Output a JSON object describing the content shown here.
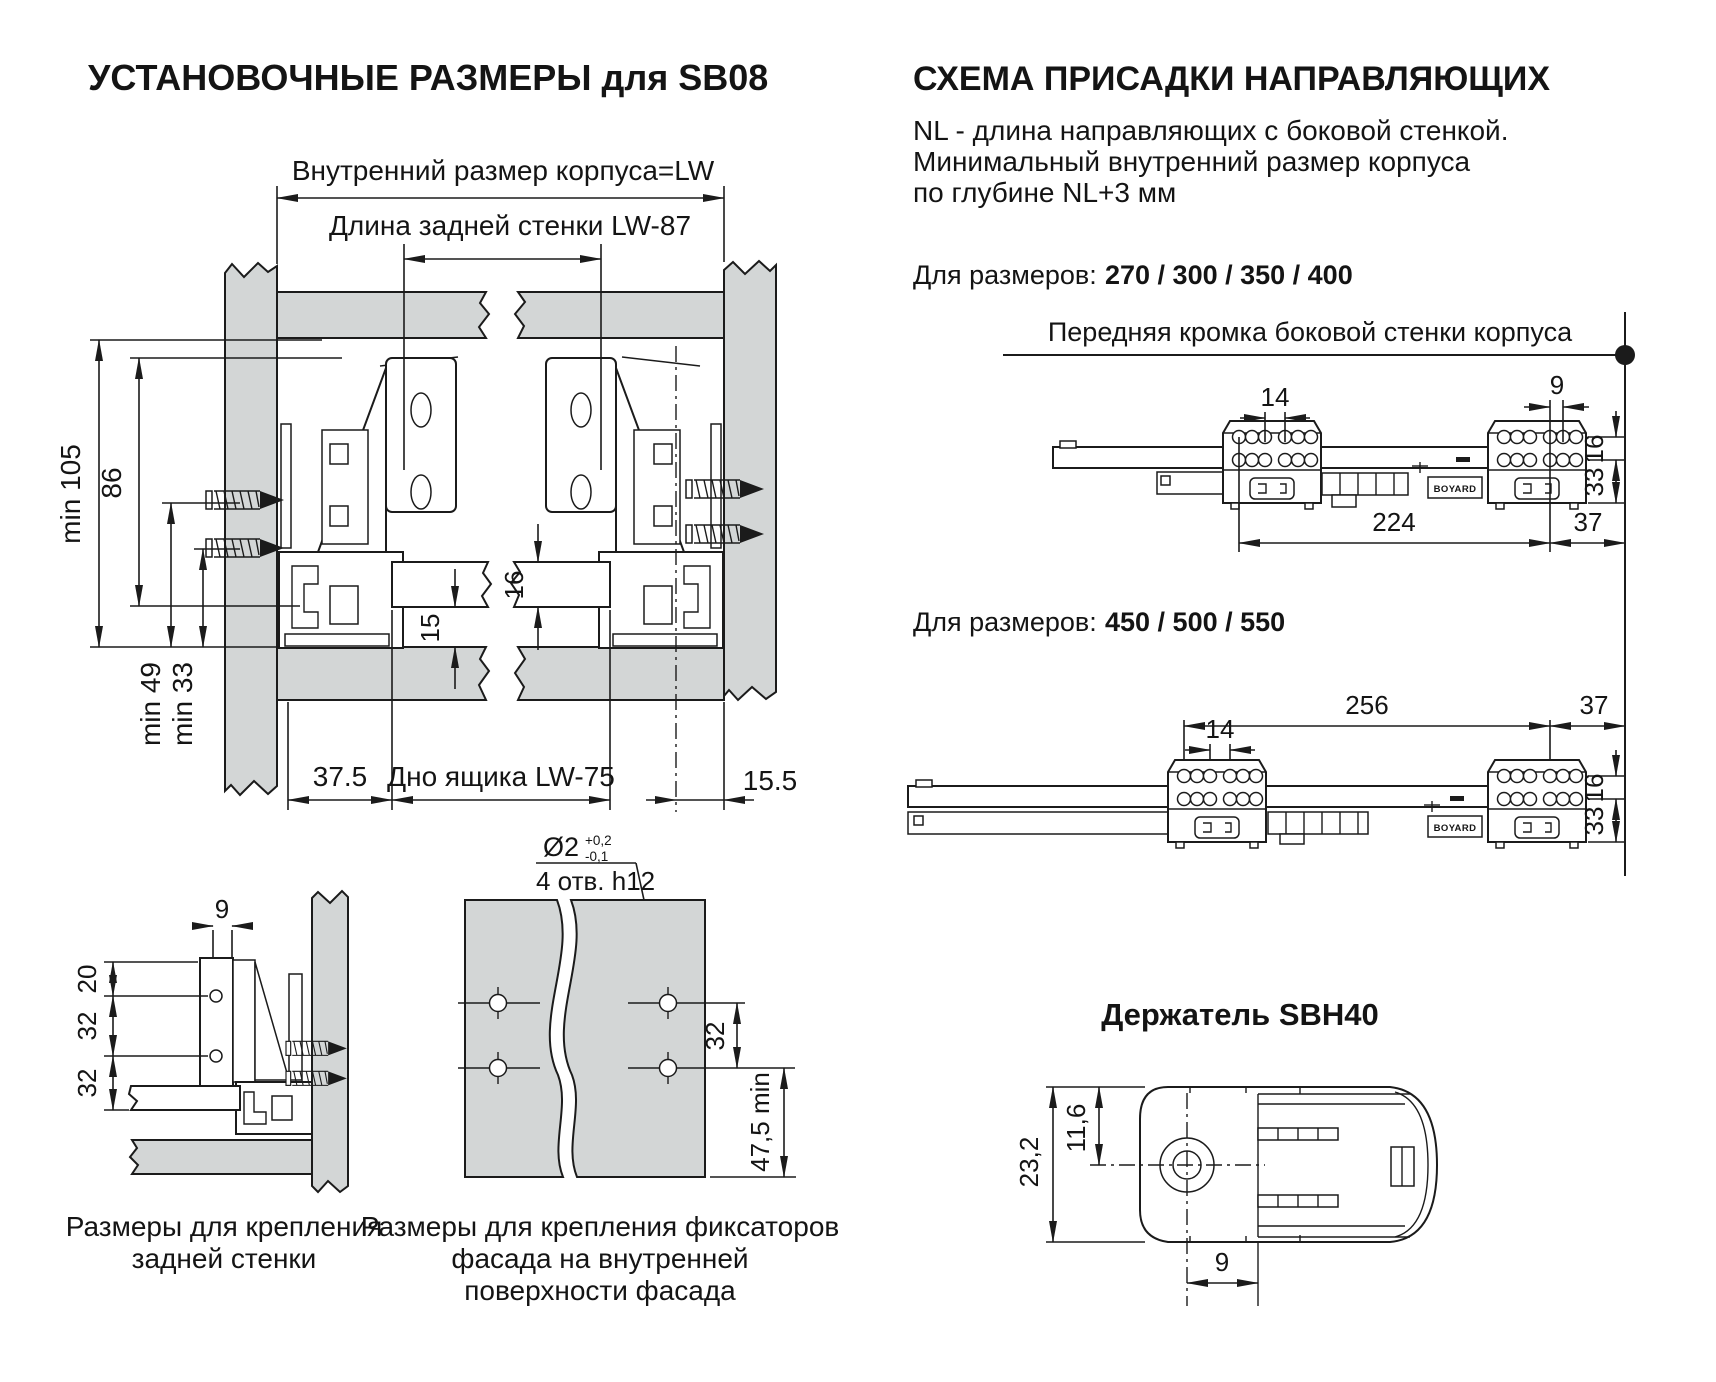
{
  "left": {
    "title": "УСТАНОВОЧНЫЕ РАЗМЕРЫ для SB08",
    "main": {
      "inner_width_label": "Внутренний размер корпуса=LW",
      "back_wall_label": "Длина задней стенки  LW-87",
      "dim_min105": "min 105",
      "dim_86": "86",
      "dim_min49": "min 49",
      "dim_min33": "min 33",
      "dim_16": "16",
      "dim_15": "15",
      "dim_37_5": "37.5",
      "bottom_label": "Дно ящика  LW-75",
      "dim_15_5": "15.5"
    },
    "rear_detail": {
      "dim_9": "9",
      "dim_20": "20",
      "dim_32a": "32",
      "dim_32b": "32",
      "caption_line1": "Размеры  для крепления",
      "caption_line2": "задней стенки"
    },
    "facade_detail": {
      "hole_dia": "Ø2",
      "tol_plus": "+0,2",
      "tol_minus": "-0,1",
      "holes_note": "4 отв. h12",
      "dim_32": "32",
      "dim_47_5": "47,5 min",
      "caption_line1": "Размеры для крепления фиксаторов",
      "caption_line2": "фасада на внутренней",
      "caption_line3": "поверхности фасада"
    }
  },
  "right": {
    "title": "СХЕМА ПРИСАДКИ НАПРАВЛЯЮЩИХ",
    "nl_note_line1": "NL - длина направляющих с боковой стенкой.",
    "nl_note_line2": "Минимальный внутренний размер корпуса",
    "nl_note_line3": "по глубине NL+3 мм",
    "sizes1_label": "Для размеров:",
    "sizes1_values": "270 / 300 / 350 / 400",
    "front_edge_label": "Передняя кромка боковой стенки корпуса",
    "rail1": {
      "dim_14": "14",
      "dim_9": "9",
      "dim_16": "16",
      "dim_33": "33",
      "dim_224": "224",
      "dim_37": "37",
      "brand": "BOYARD"
    },
    "sizes2_label": "Для размеров:",
    "sizes2_values": "450 / 500 / 550",
    "rail2": {
      "dim_14": "14",
      "dim_256": "256",
      "dim_37": "37",
      "dim_16": "16",
      "dim_33": "33",
      "brand": "BOYARD"
    },
    "holder": {
      "title": "Держатель SBH40",
      "dim_23_2": "23,2",
      "dim_11_6": "11,6",
      "dim_9": "9"
    }
  }
}
